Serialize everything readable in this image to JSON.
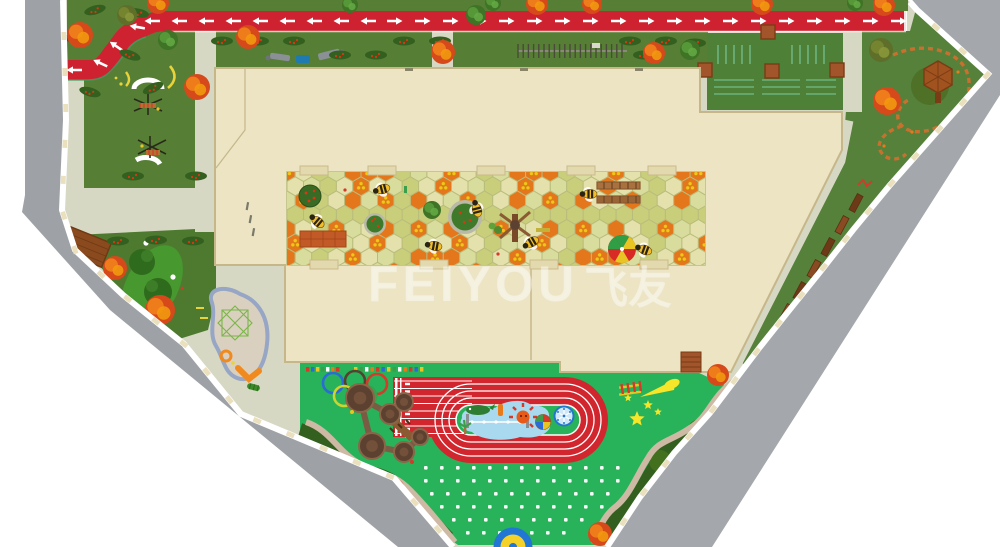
{
  "title": "kindergarten-site-plan-render",
  "watermark": {
    "text": "FEIYOU",
    "cjk": "飞友"
  },
  "colors": {
    "outside_white": "#ffffff",
    "gray_road": "#9ea2a6",
    "gray_road_right": "#a4a8ac",
    "sidewalk": "#ffffff",
    "sidewalk_tick": "#eae0bd",
    "pavement": "#d7d8c4",
    "grass": "#567f35",
    "grass_dark": "#4e7a30",
    "play_green": "#28b259",
    "road_red": "#ce2231",
    "road_edge": "#3f9f63",
    "track_red": "#d2262e",
    "building": "#ece4c3",
    "building_line": "#c6b78b",
    "court_base": "#cdd18d",
    "hex_orange": "#e4761b",
    "hex_light": "#d8dc9c",
    "hex_light2": "#c9ce7b",
    "hex_pale": "#e4e1ad",
    "hex_line": "#b9bd7c",
    "flower_yellow": "#f2c51a",
    "pool_blue": "#a9d9ef",
    "sand": "#d9d0bf",
    "sand_edge": "#97a6c4",
    "hedge": "#33601f",
    "path_tan": "#cdb9a4",
    "wood": "#8a4a22",
    "wood_dark": "#6d3a17",
    "bee_yellow": "#f1bd28",
    "white": "#ffffff"
  },
  "features": {
    "red_trees": [
      [
        80,
        35,
        13
      ],
      [
        158,
        3,
        11
      ],
      [
        248,
        37,
        12
      ],
      [
        197,
        87,
        13
      ],
      [
        443,
        52,
        12
      ],
      [
        537,
        4,
        11
      ],
      [
        592,
        4,
        10
      ],
      [
        654,
        53,
        11
      ],
      [
        762,
        4,
        11
      ],
      [
        884,
        5,
        11
      ],
      [
        887,
        101,
        14
      ],
      [
        115,
        268,
        12
      ],
      [
        160,
        310,
        15
      ],
      [
        718,
        375,
        11
      ],
      [
        393,
        490,
        12
      ],
      [
        600,
        534,
        12
      ]
    ],
    "green_trees": [
      [
        168,
        40,
        10
      ],
      [
        350,
        5,
        8
      ],
      [
        476,
        15,
        10
      ],
      [
        493,
        3,
        8
      ],
      [
        690,
        50,
        10
      ],
      [
        855,
        3,
        8
      ],
      [
        432,
        210,
        9
      ]
    ],
    "olive_trees": [
      [
        881,
        50,
        12
      ],
      [
        127,
        15,
        10
      ]
    ],
    "hedges": [
      [
        95,
        10,
        -15
      ],
      [
        138,
        13,
        10
      ],
      [
        75,
        38,
        0
      ],
      [
        130,
        55,
        20
      ],
      [
        153,
        88,
        -25
      ],
      [
        90,
        92,
        15
      ],
      [
        222,
        41,
        0
      ],
      [
        258,
        41,
        0
      ],
      [
        294,
        41,
        0
      ],
      [
        404,
        41,
        0
      ],
      [
        440,
        41,
        0
      ],
      [
        630,
        41,
        0
      ],
      [
        666,
        41,
        0
      ],
      [
        695,
        43,
        0
      ],
      [
        340,
        55,
        0
      ],
      [
        376,
        55,
        0
      ],
      [
        644,
        55,
        0
      ],
      [
        133,
        176,
        0
      ],
      [
        196,
        176,
        0
      ],
      [
        118,
        241,
        0
      ],
      [
        156,
        240,
        0
      ],
      [
        193,
        241,
        0
      ]
    ],
    "bees": [
      [
        318,
        222,
        40
      ],
      [
        383,
        189,
        -15
      ],
      [
        435,
        246,
        10
      ],
      [
        477,
        210,
        75
      ],
      [
        590,
        194,
        0
      ],
      [
        532,
        242,
        -30
      ],
      [
        645,
        250,
        20
      ]
    ],
    "road_arrows": {
      "left_y": 21,
      "left_xs": [
        152,
        179,
        206,
        233,
        260,
        287,
        314,
        341,
        368
      ],
      "right_y": 21,
      "right_xs": [
        395,
        423,
        451,
        479,
        507,
        535,
        563,
        591,
        619,
        647,
        675,
        703,
        731,
        759,
        787,
        815,
        843,
        871,
        899
      ],
      "curve": [
        [
          74,
          70,
          180
        ],
        [
          100,
          63,
          -155
        ],
        [
          116,
          46,
          -145
        ],
        [
          137,
          27,
          -170
        ]
      ]
    },
    "dot_grid": {
      "rows": [
        {
          "y": 466,
          "x0": 424,
          "x1": 616
        },
        {
          "y": 479,
          "x0": 424,
          "x1": 616
        },
        {
          "y": 492,
          "x0": 430,
          "x1": 610
        },
        {
          "y": 505,
          "x0": 440,
          "x1": 600
        },
        {
          "y": 518,
          "x0": 452,
          "x1": 588
        },
        {
          "y": 531,
          "x0": 466,
          "x1": 574
        }
      ],
      "step": 16
    },
    "olympic_rings": [
      {
        "x": 333,
        "y": 383,
        "c": "#2b6bd6"
      },
      {
        "x": 355,
        "y": 381,
        "c": "#54412f"
      },
      {
        "x": 377,
        "y": 384,
        "c": "#d63a2a"
      },
      {
        "x": 344,
        "y": 396,
        "c": "#cdd32f"
      },
      {
        "x": 366,
        "y": 396,
        "c": "#3a9e4a"
      }
    ],
    "court_tabs": {
      "top_y": 166,
      "top_xs": [
        300,
        368,
        477,
        567,
        648
      ],
      "bottom_y": 260,
      "bottom_xs": [
        310,
        420,
        530,
        640
      ]
    },
    "wood_trail": [
      [
        856,
        203
      ],
      [
        842,
        225
      ],
      [
        828,
        247
      ],
      [
        814,
        269
      ],
      [
        800,
        291
      ],
      [
        786,
        313
      ],
      [
        772,
        335
      ],
      [
        758,
        357
      ]
    ],
    "plot_planters": [
      [
        768,
        32
      ],
      [
        705,
        70
      ],
      [
        772,
        71
      ],
      [
        837,
        70
      ]
    ],
    "stars": [
      [
        637,
        419,
        8
      ],
      [
        648,
        405,
        5
      ],
      [
        658,
        412,
        4
      ],
      [
        628,
        398,
        4
      ]
    ],
    "towers": [
      [
        360,
        398,
        14
      ],
      [
        390,
        414,
        10
      ],
      [
        404,
        402,
        9
      ],
      [
        372,
        446,
        13
      ],
      [
        404,
        452,
        10
      ],
      [
        420,
        437,
        8
      ]
    ],
    "chute_lanes": [
      381,
      388.5,
      396,
      403.5,
      411,
      418.5,
      426,
      433.5
    ],
    "fence": {
      "x0": 518,
      "x1": 627,
      "y0": 44,
      "y1": 58
    },
    "pavement_dashes": [
      [
        247,
        202
      ],
      [
        250,
        215
      ],
      [
        253,
        228
      ]
    ]
  }
}
